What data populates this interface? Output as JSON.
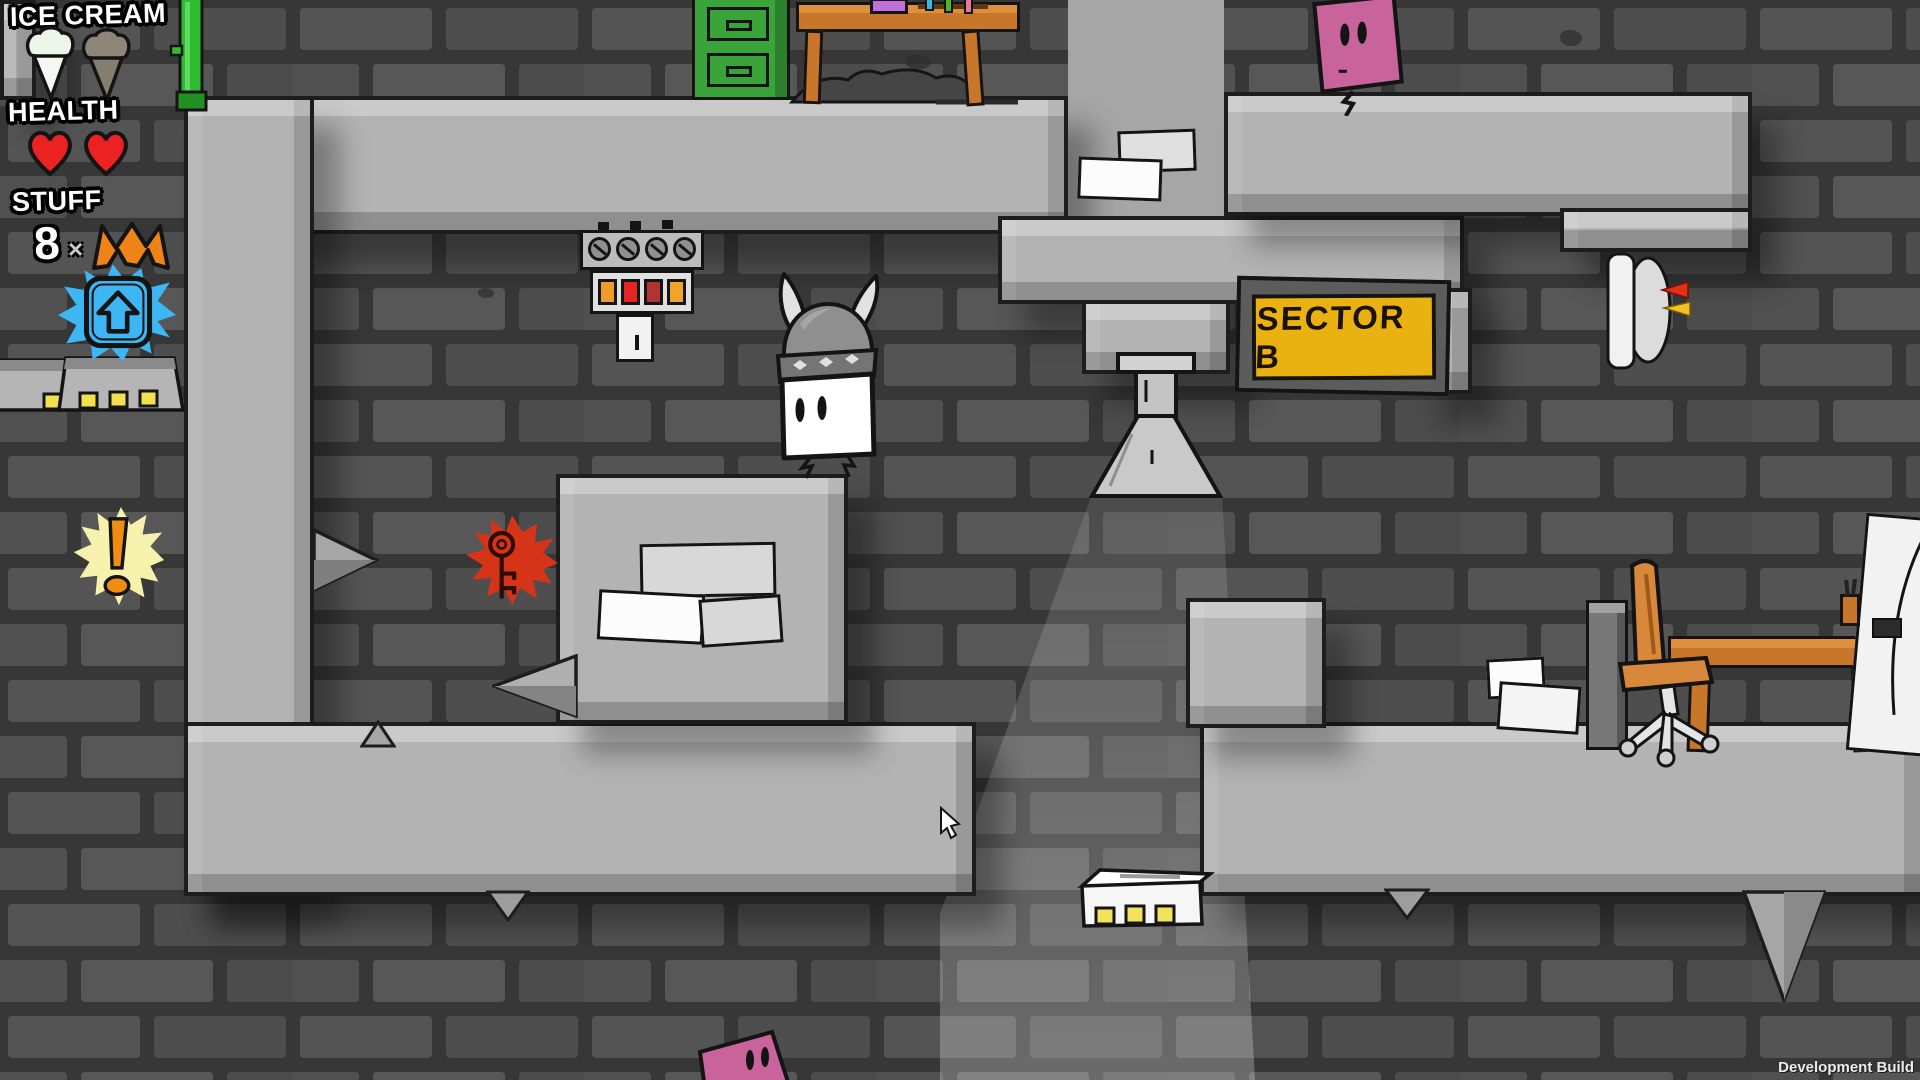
{
  "window": {
    "dev_build_label": "Development Build"
  },
  "hud": {
    "ice_cream": {
      "label": "ICE CREAM",
      "icons": [
        {
          "name": "ice-cream-cone",
          "state": "available",
          "color": "#eef6ea"
        },
        {
          "name": "ice-cream-cone",
          "state": "spent",
          "color": "#8e8678"
        }
      ]
    },
    "health": {
      "label": "HEALTH",
      "hearts": 2,
      "heart_color": "#ec2222"
    },
    "stuff": {
      "label": "STUFF",
      "count": "8",
      "multiplier": "×",
      "bolt_icon_color": "#ee8418",
      "jump_pickup_color": "#3fb6f4"
    }
  },
  "signs": {
    "sector_sign": {
      "text": "SECTOR B",
      "panel_color": "#e9b211",
      "frame_color": "#5c5c5c"
    }
  },
  "entities": {
    "player": {
      "name": "viking-square-character",
      "body_color": "#ffffff",
      "helmet_color": "#8f8f8f"
    },
    "enemies": [
      {
        "name": "pink-square-enemy",
        "location": "top-right-platform",
        "color": "#c8639b"
      },
      {
        "name": "pink-square-enemy",
        "location": "bottom-center",
        "color": "#c8639b"
      }
    ],
    "pickups": [
      {
        "name": "key-splat",
        "color": "#d63418"
      },
      {
        "name": "exclamation-burst",
        "color": "#f6f2ad"
      },
      {
        "name": "jump-upgrade-splat",
        "color": "#3fb6f4"
      }
    ]
  },
  "environment": {
    "brick_color": "#525252",
    "mortar_color": "#373737",
    "platform_color": "#b3b3b3",
    "lamp": "cone-ceiling-lamp",
    "light_beam": "rgba(255,255,255,0.2)"
  }
}
